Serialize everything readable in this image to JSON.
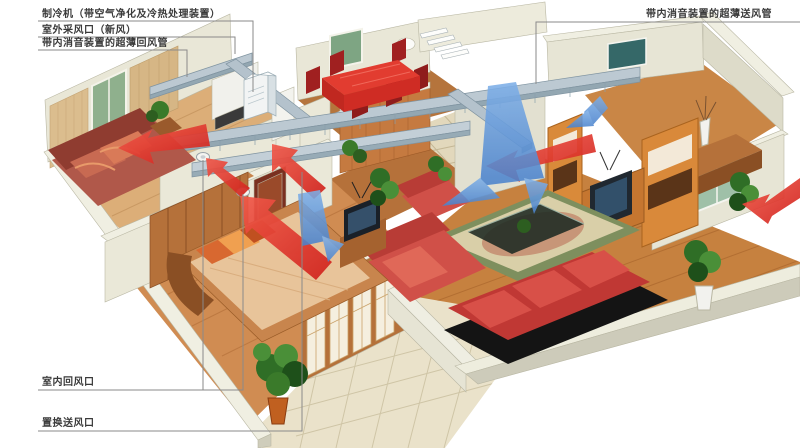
{
  "diagram": {
    "type": "hvac-apartment-cutaway-illustration",
    "callouts": {
      "chiller": {
        "text": "制冷机（带空气净化及冷热处理装置）"
      },
      "fresh_air_inlet": {
        "text": "室外采风口（新风）"
      },
      "return_duct": {
        "text": "带内消音装置的超薄回风管"
      },
      "supply_duct": {
        "text": "带内消音装置的超薄送风管"
      },
      "indoor_return_outlet": {
        "text": "室内回风口"
      },
      "displacement_supply_outlet": {
        "text": "置换送风口"
      }
    },
    "colors": {
      "red_airflow": "#e8382c",
      "blue_airflow": "#5b94da",
      "duct_metal": "#bcc9d2",
      "wall_cream": "#e9e7d7",
      "wood_floor": "#c6813f",
      "tile_floor": "#eae2ca",
      "sofa_red": "#d05048",
      "leader_line": "#8a8a8a"
    }
  }
}
